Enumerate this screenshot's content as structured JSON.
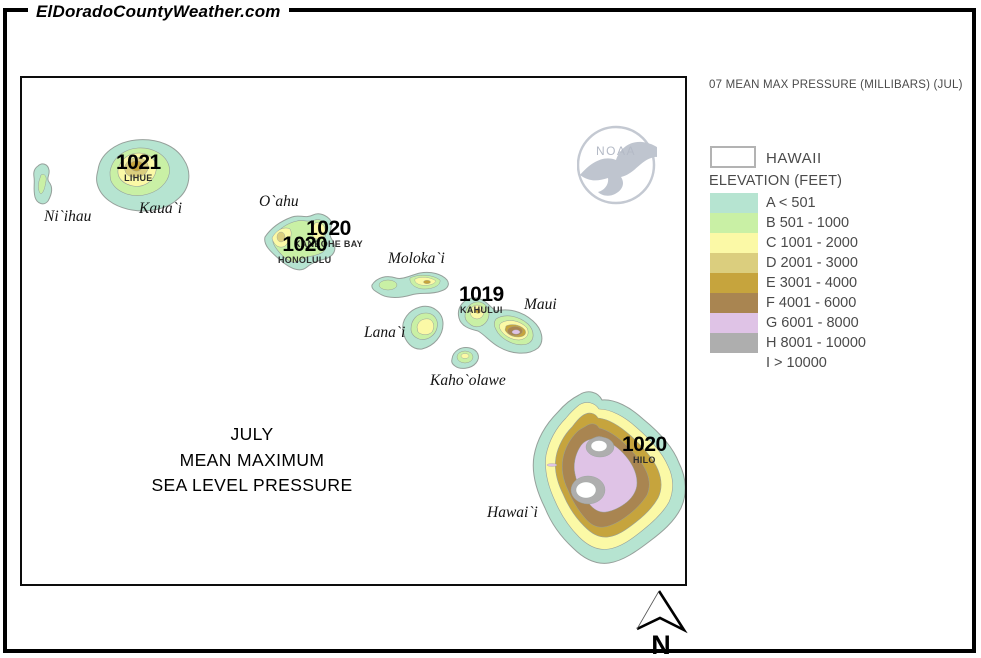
{
  "site": {
    "title": "ElDoradoCountyWeather.com"
  },
  "colors": {
    "a": "#b6e4d1",
    "b": "#c9f0a5",
    "c": "#fbf9a6",
    "d": "#dbce7e",
    "e": "#c6a43d",
    "f": "#a98551",
    "g": "#dfc3e6",
    "h": "#aeaeae",
    "i": "#ffffff"
  },
  "map": {
    "title_line1": "JULY",
    "title_line2": "MEAN MAXIMUM",
    "title_line3": "SEA LEVEL PRESSURE",
    "labels": {
      "niihau": "Ni`ihau",
      "kauai": "Kaua`i",
      "oahu": "O`ahu",
      "molokai": "Moloka`i",
      "lanai": "Lana`i",
      "maui": "Maui",
      "kahoolawe": "Kaho`olawe",
      "hawaii": "Hawai`i"
    },
    "stations": {
      "lihue": {
        "value": "1021",
        "name": "LIHUE"
      },
      "kaneohe": {
        "value": "1020",
        "name": "KANEOHE BAY"
      },
      "honolulu": {
        "value": "1020",
        "name": "HONOLULU"
      },
      "kahului": {
        "value": "1019",
        "name": "KAHULUI"
      },
      "hilo": {
        "value": "1020",
        "name": "HILO"
      }
    },
    "noaa_label": "NOAA"
  },
  "legend": {
    "header": "07 MEAN MAX PRESSURE (MILLIBARS) (JUL)",
    "region_label": "HAWAII",
    "elevation_title": "ELEVATION (FEET)",
    "classes": [
      {
        "label": "A < 501",
        "color": "#b6e4d1"
      },
      {
        "label": "B 501 - 1000",
        "color": "#c9f0a5"
      },
      {
        "label": "C 1001 - 2000",
        "color": "#fbf9a6"
      },
      {
        "label": "D 2001 - 3000",
        "color": "#dbce7e"
      },
      {
        "label": "E 3001 - 4000",
        "color": "#c6a43d"
      },
      {
        "label": "F 4001 - 6000",
        "color": "#a98551"
      },
      {
        "label": "G 6001 - 8000",
        "color": "#dfc3e6"
      },
      {
        "label": "H 8001 - 10000",
        "color": "#aeaeae"
      },
      {
        "label": "I > 10000",
        "color": "#ffffff"
      }
    ]
  },
  "compass": {
    "label": "N"
  }
}
